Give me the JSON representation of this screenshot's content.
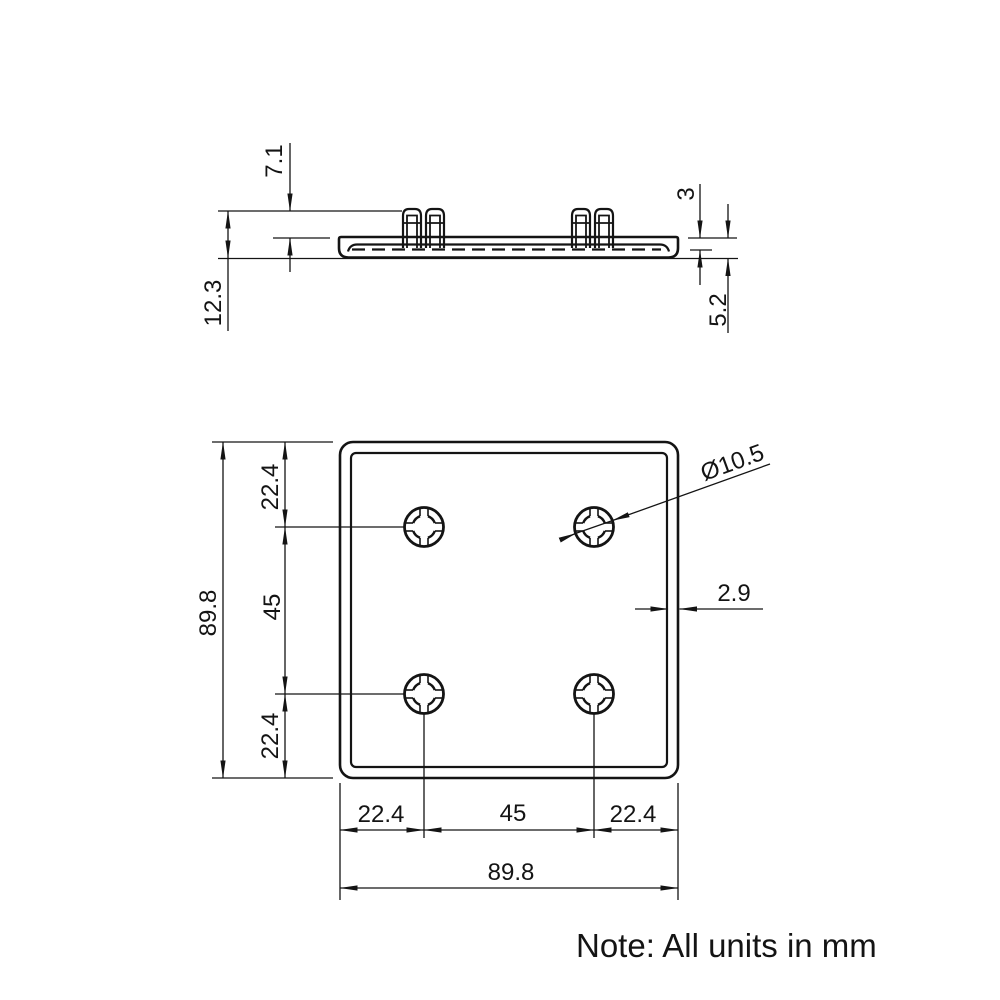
{
  "drawing": {
    "note": "Note: All units in mm",
    "colors": {
      "line": "#141414",
      "background": "#ffffff"
    },
    "side_view": {
      "clip_height": "7.1",
      "total_height": "12.3",
      "face_thickness": "3",
      "cap_thickness": "5.2"
    },
    "front_view": {
      "height_total": "89.8",
      "top_offset": "22.4",
      "row_pitch": "45",
      "bottom_offset": "22.4",
      "left_offset": "22.4",
      "col_pitch": "45",
      "right_offset": "22.4",
      "width_total": "89.8",
      "hole_diameter": "Ø10.5",
      "wall_thickness": "2.9"
    }
  }
}
